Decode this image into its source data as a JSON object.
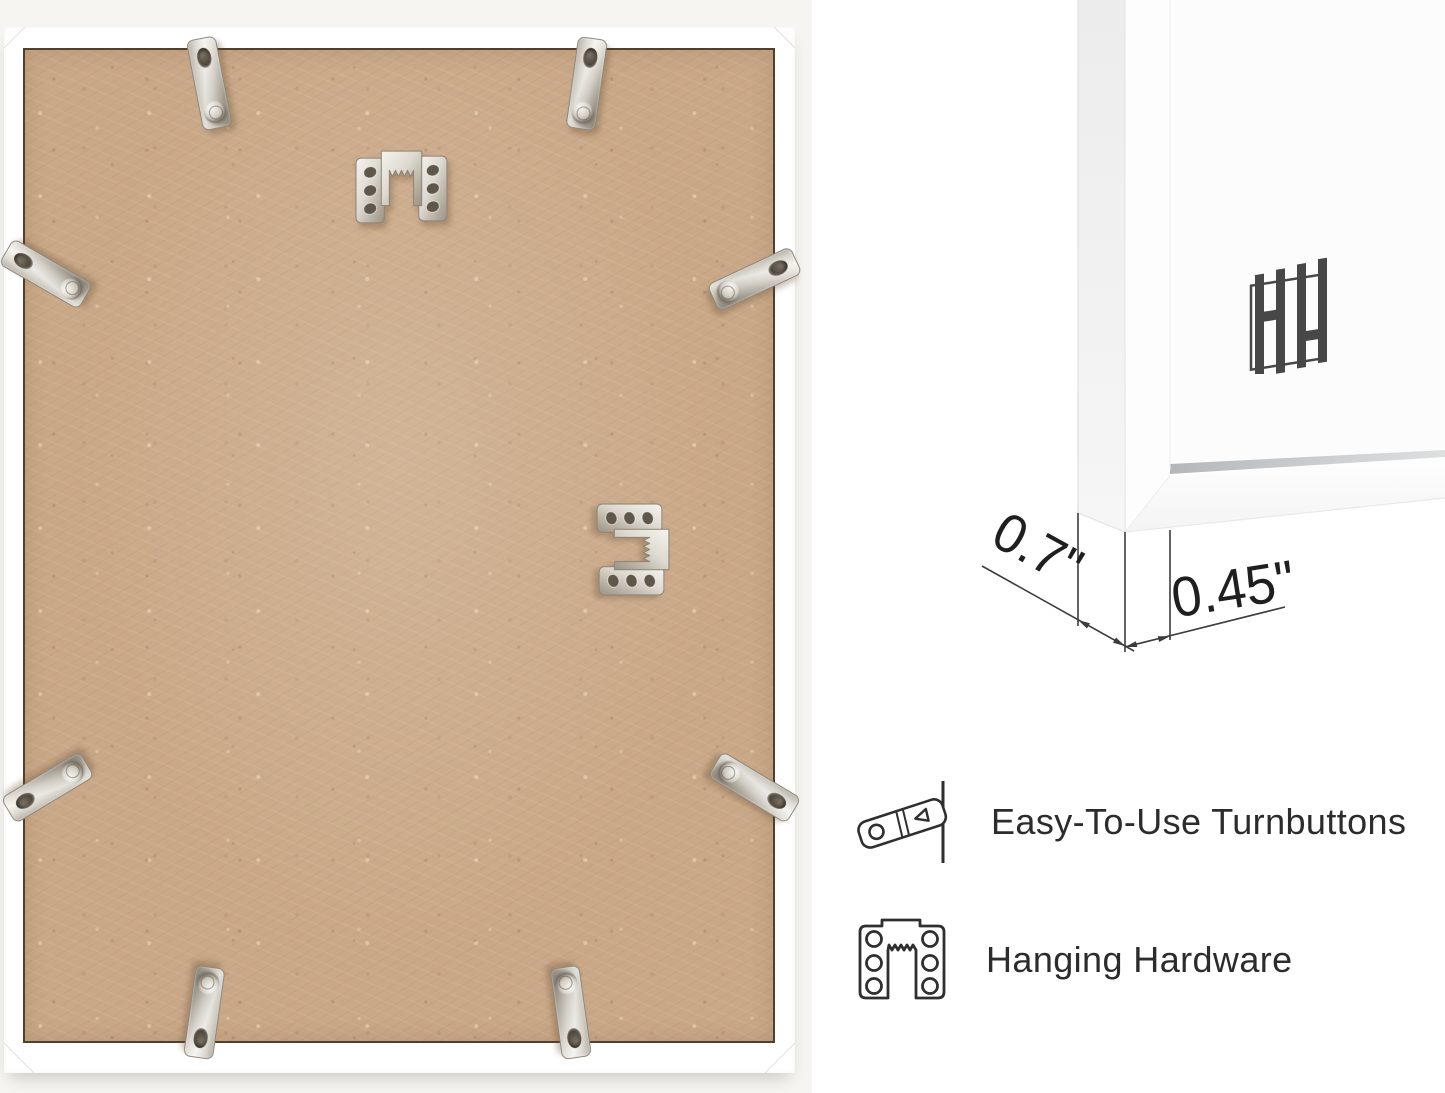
{
  "page": {
    "background_color": "#ffffff"
  },
  "product_photo": {
    "name": "frame-back-photo",
    "background_color": "#f6f5f2",
    "frame_color": "#ffffff",
    "board_color": "#c9a887",
    "turnbutton_count": 8,
    "sawtooth_hanger_count": 2
  },
  "corner_render": {
    "name": "frame-corner-render",
    "frame_color": "#fcfcfc"
  },
  "brand_logo": {
    "name": "hh-logo",
    "color": "#474747"
  },
  "dimensions": {
    "side_depth": "0.7\"",
    "face_width": "0.45\""
  },
  "features": [
    {
      "icon": "turnbutton-icon",
      "label": "Easy-To-Use Turnbuttons"
    },
    {
      "icon": "hanging-hardware-icon",
      "label": "Hanging Hardware"
    }
  ]
}
